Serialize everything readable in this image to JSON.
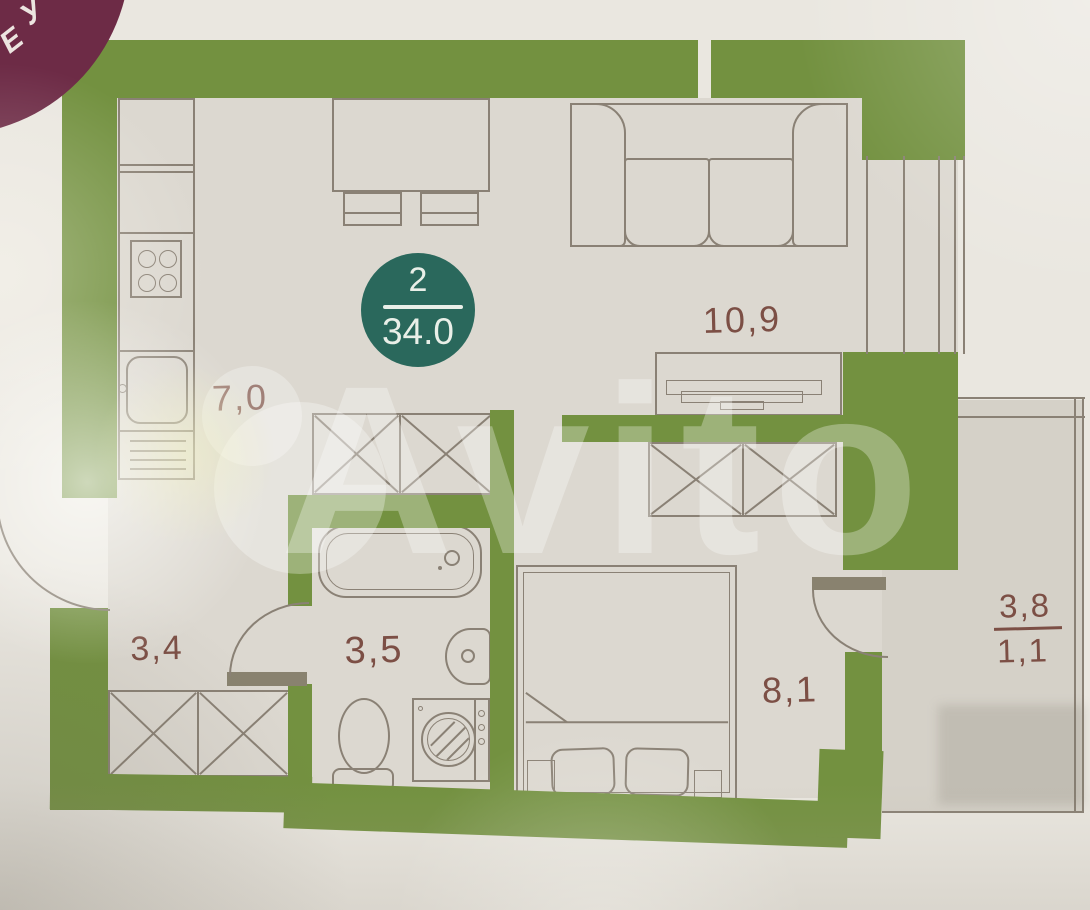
{
  "plan": {
    "unit_badge": {
      "rooms_count": "2",
      "total_area": "34.0"
    },
    "rooms": {
      "kitchen": {
        "label": "7,0"
      },
      "living": {
        "label": "10,9"
      },
      "hall": {
        "label": "3,4"
      },
      "bathroom": {
        "label": "3,5"
      },
      "bedroom": {
        "label": "8,1"
      },
      "balcony": {
        "area_total": "3,8",
        "area_reduced": "1,1"
      }
    }
  },
  "corner_badge": {
    "char1": "У",
    "char2": "Е"
  },
  "watermark": {
    "text": "Avito"
  },
  "colors": {
    "wall_green": "#739140",
    "badge_teal": "#2a685c",
    "label_text": "#7c4f45",
    "furniture_line": "#8a8175",
    "corner_badge_maroon": "#6d2b46",
    "floor": "#dcd8d0",
    "paper": "#eae7e0"
  }
}
